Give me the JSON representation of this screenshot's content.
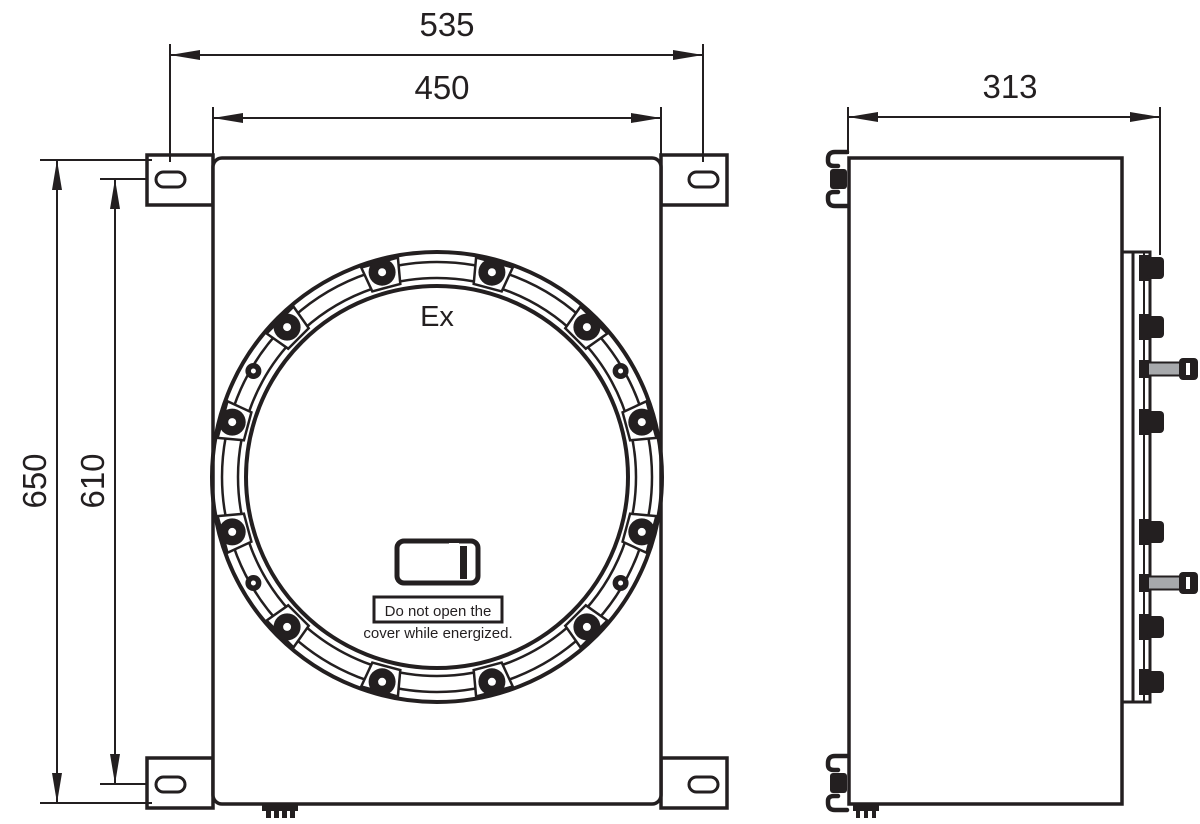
{
  "drawing": {
    "type": "technical-drawing",
    "views": {
      "front": {
        "ex_marking": "Ex",
        "warning_label": {
          "line1": "Do not open the",
          "line2": "cover while energized."
        },
        "dimensions": {
          "overall_width_mm": "535",
          "body_width_mm": "450",
          "overall_height_mm": "650",
          "mounting_hole_spacing_mm": "610"
        }
      },
      "side": {
        "dimensions": {
          "depth_mm": "313"
        }
      }
    },
    "colors": {
      "line": "#231f20",
      "background": "#ffffff",
      "pin_shaft": "#a7a9ac"
    }
  }
}
